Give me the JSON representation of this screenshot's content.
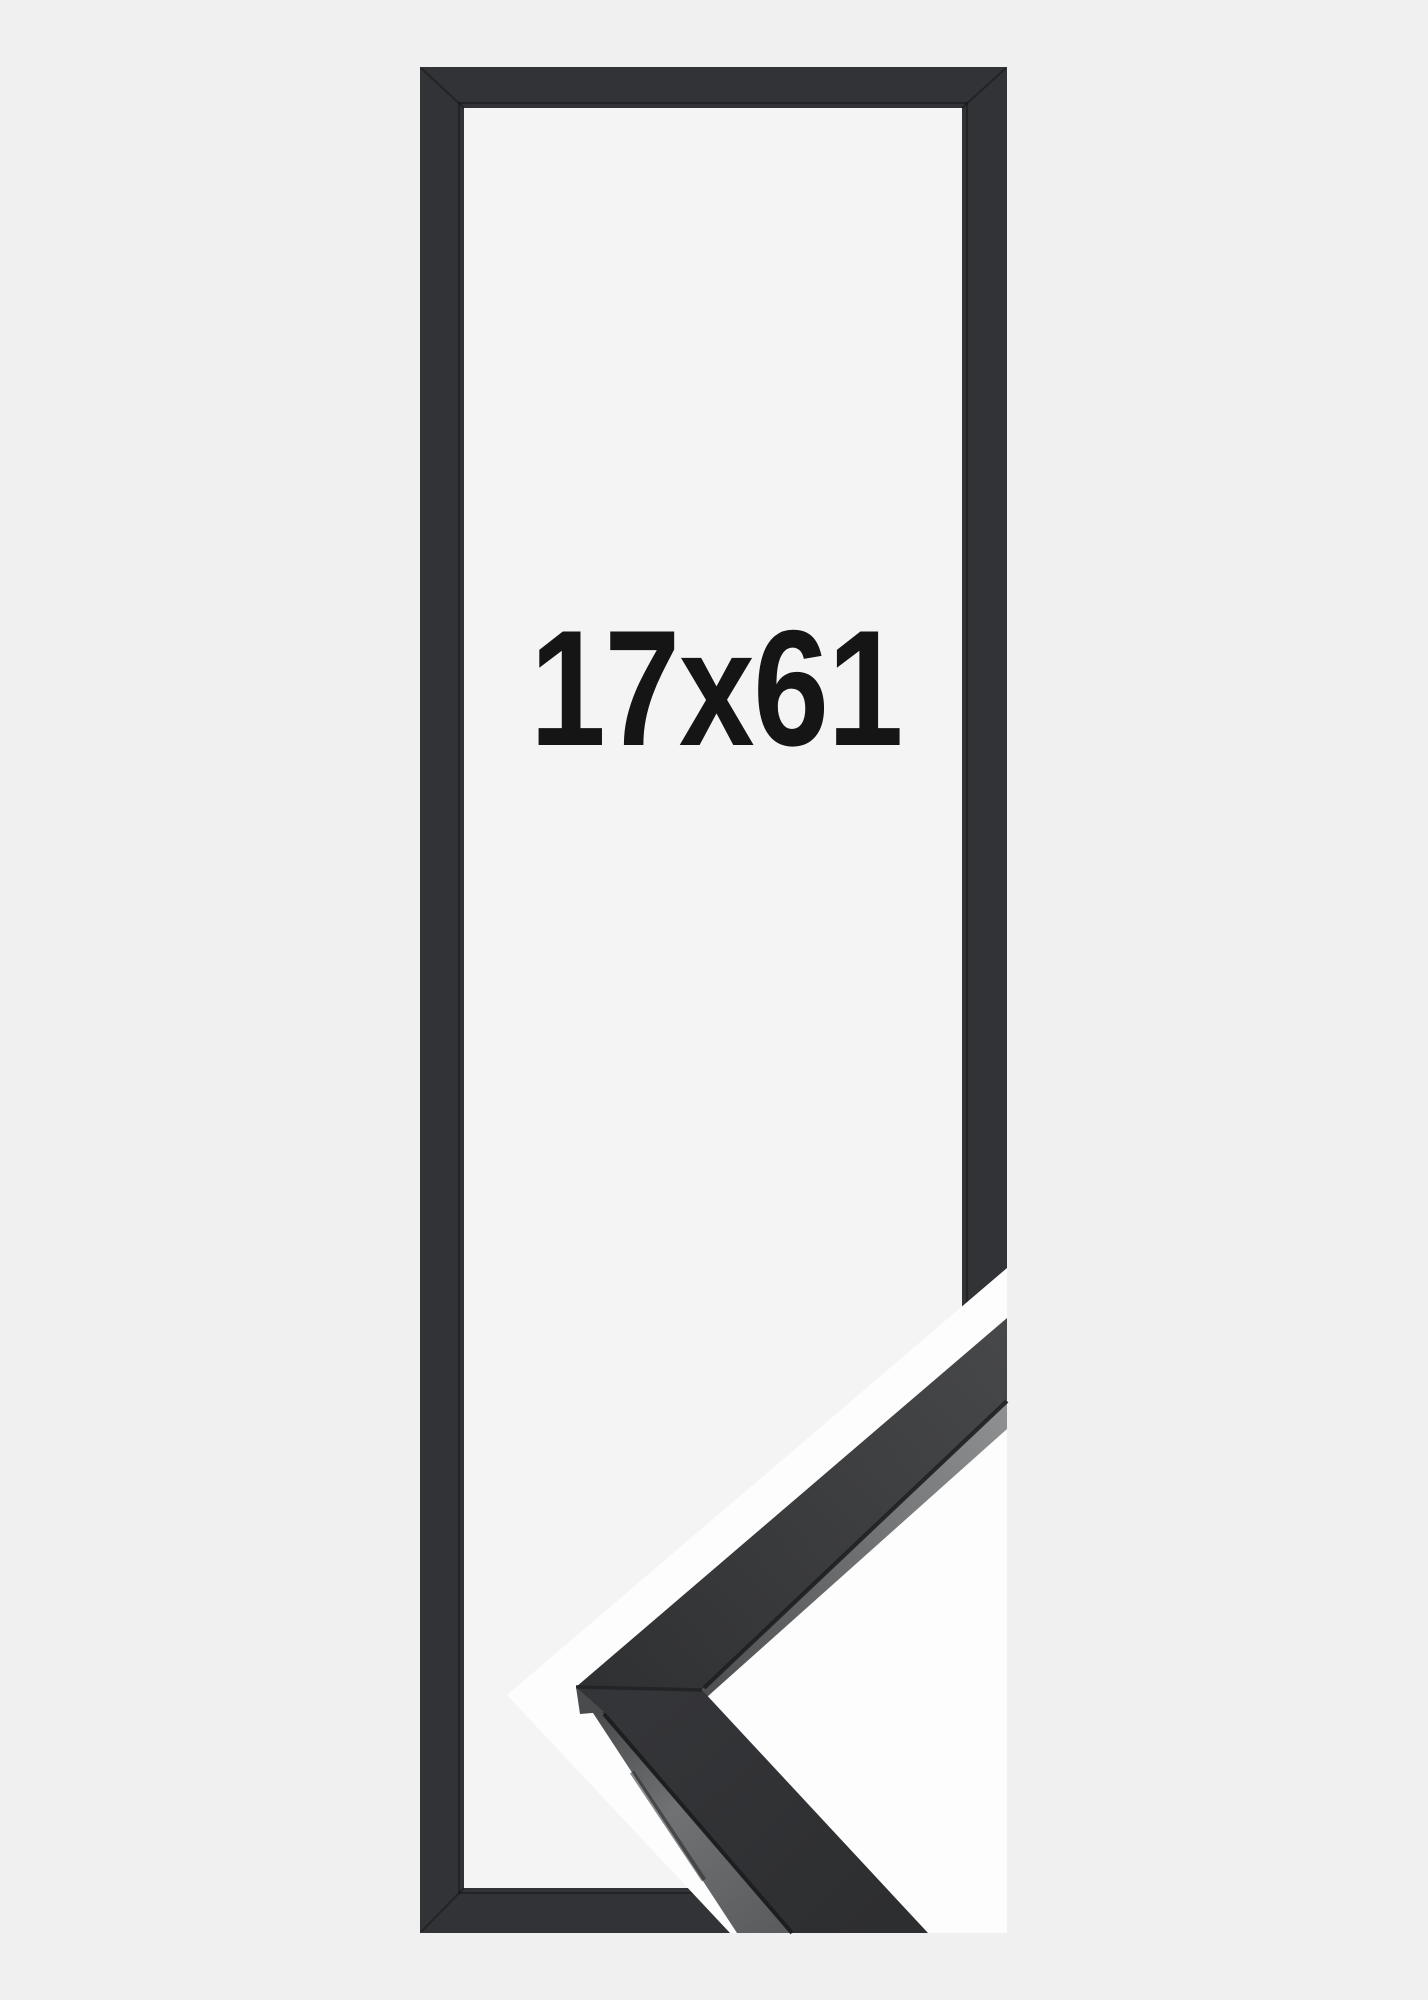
{
  "product": {
    "size_label": "17x61"
  },
  "colors": {
    "page_background": "#f0f0f1",
    "interior_background": "#f4f4f5",
    "frame_moulding": "#323336",
    "label_text": "#151515",
    "sample_photo_background": "#fdfdfe",
    "seam": "#1d1e20",
    "miter_seam": "#232426",
    "upper_face_start": "#2f3032",
    "upper_face_end": "#47484a",
    "lip_start": "#4d4f51",
    "lip_end": "#8f9193",
    "lower_face_start": "#343538",
    "lower_face_end": "#2d2e30",
    "side_start": "#47484a",
    "side_mid": "#707274",
    "side_end": "#5a5c5e",
    "apex_facet": "#4a4b4d",
    "bottom_edge_hint": "#28292b"
  }
}
